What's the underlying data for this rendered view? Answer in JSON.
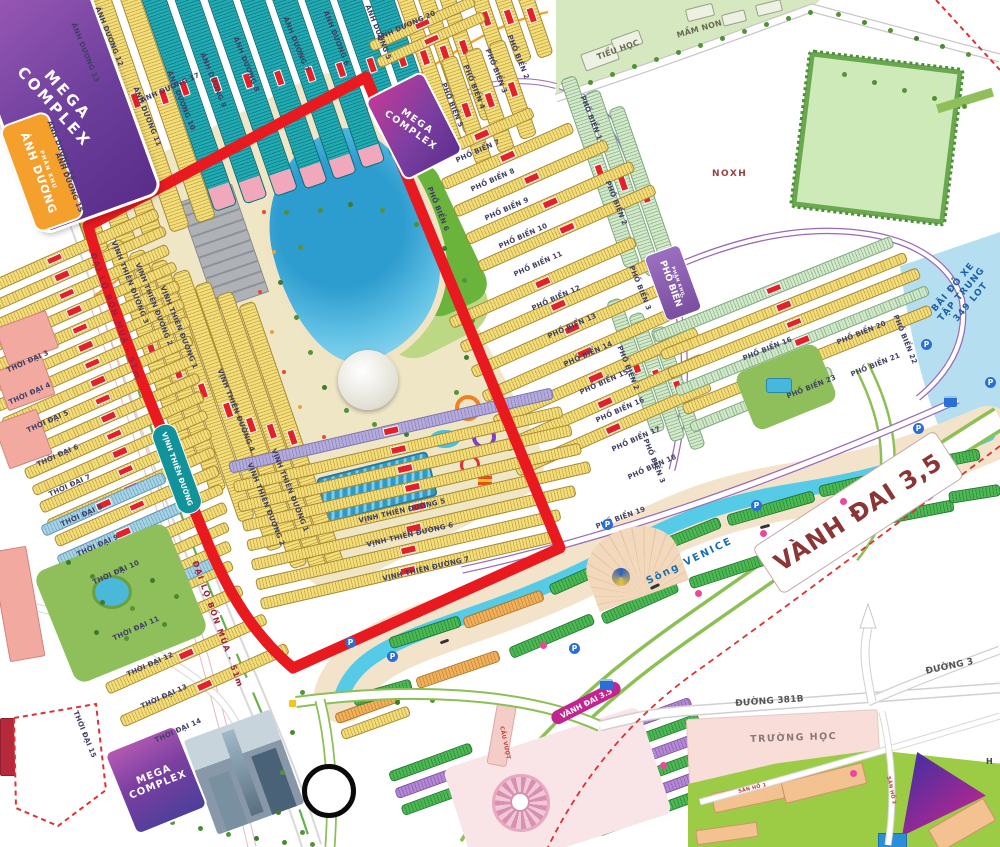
{
  "region_badges": {
    "mega_complex": "MEGA\nCOMPLEX",
    "phan_khu": "PHÂN KHU",
    "anh_duong": "ÁNH DƯƠNG",
    "pho_bien": "PHỐ BIỂN",
    "vinh_thien_duong": "VỊNH THIÊN ĐƯỜNG"
  },
  "area_labels": {
    "noxh": "NOXH",
    "truong_hoc": "TRƯỜNG HỌC",
    "tieu_hoc": "TIỂU HỌC",
    "mam_non": "MẦM NON",
    "h_partial": "H"
  },
  "road_labels": {
    "dai_lo_bon_mua": "ĐẠI LỘ BỐN MÙA - 51m",
    "vanh_dai_big": "VÀNH ĐAI 3,5",
    "vanh_dai_pill": "VÀNH ĐAI 3.5",
    "duong_381b": "ĐƯỜNG 381B",
    "duong_3": "ĐƯỜNG 3",
    "song_venice": "Sông VENICE",
    "cau_vuot": "CẦU VƯỢT",
    "san_ho_1": "SÂN HỒ 1",
    "san_ho_2": "SÂN HỒ 2"
  },
  "parking_area": {
    "line1": "BÃI ĐỖ XE",
    "line2": "TẬP TRUNG",
    "line3": "349 LOT"
  },
  "streets": {
    "anh_duong": [
      "ÁNH DƯƠNG 5",
      "ÁNH DƯƠNG 6",
      "ÁNH DƯƠNG 7",
      "ÁNH DƯƠNG 8",
      "ÁNH DƯƠNG 9",
      "ÁNH DƯƠNG 10",
      "ÁNH DƯƠNG 11",
      "ÁNH DƯƠNG 12",
      "ÁNH DƯƠNG 13",
      "ÁNH DƯƠNG 14",
      "ÁNH DƯƠNG 15",
      "ÁNH DƯƠNG 17",
      "ÁNH DƯƠNG 20"
    ],
    "pho_bien": [
      "PHỐ BIỂN 1",
      "PHỐ BIỂN 2",
      "PHỐ BIỂN 3",
      "PHỐ BIỂN 4",
      "PHỐ BIỂN 5",
      "PHỐ BIỂN 6",
      "PHỐ BIỂN 7",
      "PHỐ BIỂN 8",
      "PHỐ BIỂN 9",
      "PHỐ BIỂN 10",
      "PHỐ BIỂN 11",
      "PHỐ BIỂN 12",
      "PHỐ BIỂN 13",
      "PHỐ BIỂN 14",
      "PHỐ BIỂN 15",
      "PHỐ BIỂN 16",
      "PHỐ BIỂN 17",
      "PHỐ BIỂN 18",
      "PHỐ BIỂN 19",
      "PHỐ BIỂN 20",
      "PHỐ BIỂN 21",
      "PHỐ BIỂN 22",
      "PHỐ BIỂN 23"
    ],
    "vinh_thien_duong": [
      "VỊNH THIÊN ĐƯỜNG 1",
      "VỊNH THIÊN ĐƯỜNG 2",
      "VỊNH THIÊN ĐƯỜNG 3",
      "VỊNH THIÊN ĐƯỜNG 4",
      "VỊNH THIÊN ĐƯỜNG 5",
      "VỊNH THIÊN ĐƯỜNG 6",
      "VỊNH THIÊN ĐƯỜNG 7"
    ],
    "thoi_dai": [
      "THỜI ĐẠI 3",
      "THỜI ĐẠI 4",
      "THỜI ĐẠI 5",
      "THỜI ĐẠI 6",
      "THỜI ĐẠI 7",
      "THỜI ĐẠI 8",
      "THỜI ĐẠI 9",
      "THỜI ĐẠI 10",
      "THỜI ĐẠI 11",
      "THỜI ĐẠI 12",
      "THỜI ĐẠI 13",
      "THỜI ĐẠI 14",
      "THỜI ĐẠI 15"
    ]
  },
  "markers": {
    "parking": "P"
  },
  "colors": {
    "highlight_outline": "#e81a20",
    "canal_water": "#56cbe8",
    "lake_water": "#2f9fd0",
    "rows_yellow": "#f3de7e",
    "rows_teal": "#23aab2",
    "rows_green": "#4cb854",
    "badge_purple": "#7b4fa0",
    "badge_orange": "#f59f2c",
    "badge_teal": "#12939b",
    "badge_magenta": "#c2258f"
  }
}
